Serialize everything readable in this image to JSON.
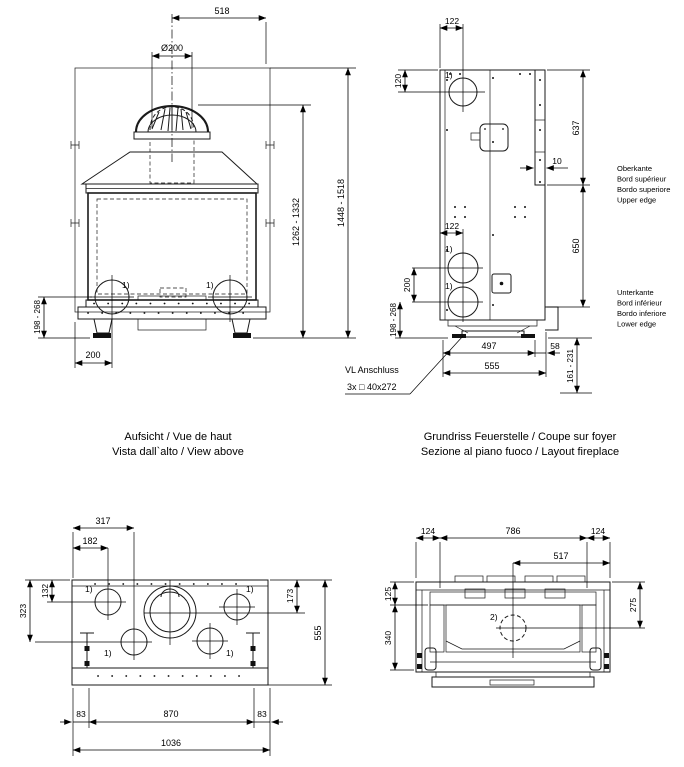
{
  "front": {
    "caption1": "Aufsicht / Vue de haut",
    "caption2": "Vista dall`alto / View above",
    "d518": "518",
    "dflue": "Ø200",
    "d1262": "1262 - 1332",
    "d1448": "1448 - 1518",
    "d198": "198 - 268",
    "d200": "200",
    "n1l": "1)",
    "n1r": "1)"
  },
  "side": {
    "caption1": "Grundriss Feuerstelle / Coupe sur foyer",
    "caption2": "Sezione al piano fuoco / Layout fireplace",
    "d122top": "122",
    "d120": "120",
    "d637": "637",
    "d10": "10",
    "d122mid": "122",
    "d200": "200",
    "d198": "198 - 268",
    "d650": "650",
    "d497": "497",
    "d58": "58",
    "d555": "555",
    "d161": "161 - 231",
    "n1top": "1)",
    "n1mid": "1)",
    "n1low": "1)",
    "vl1": "VL Anschluss",
    "vl2": "3x □ 40x272",
    "ober1": "Oberkante",
    "ober2": "Bord supérieur",
    "ober3": "Bordo superiore",
    "ober4": "Upper edge",
    "unter1": "Unterkante",
    "unter2": "Bord inférieur",
    "unter3": "Bordo inferiore",
    "unter4": "Lower edge"
  },
  "top": {
    "d317": "317",
    "d182": "182",
    "d132": "132",
    "d323": "323",
    "d173": "173",
    "d555": "555",
    "d83l": "83",
    "d870": "870",
    "d83r": "83",
    "d1036": "1036",
    "n1tl": "1)",
    "n1tr": "1)",
    "n1bl": "1)",
    "n1br": "1)"
  },
  "section": {
    "d124l": "124",
    "d786": "786",
    "d124r": "124",
    "d517": "517",
    "d125": "125",
    "d340": "340",
    "d275": "275",
    "n2": "2)"
  }
}
